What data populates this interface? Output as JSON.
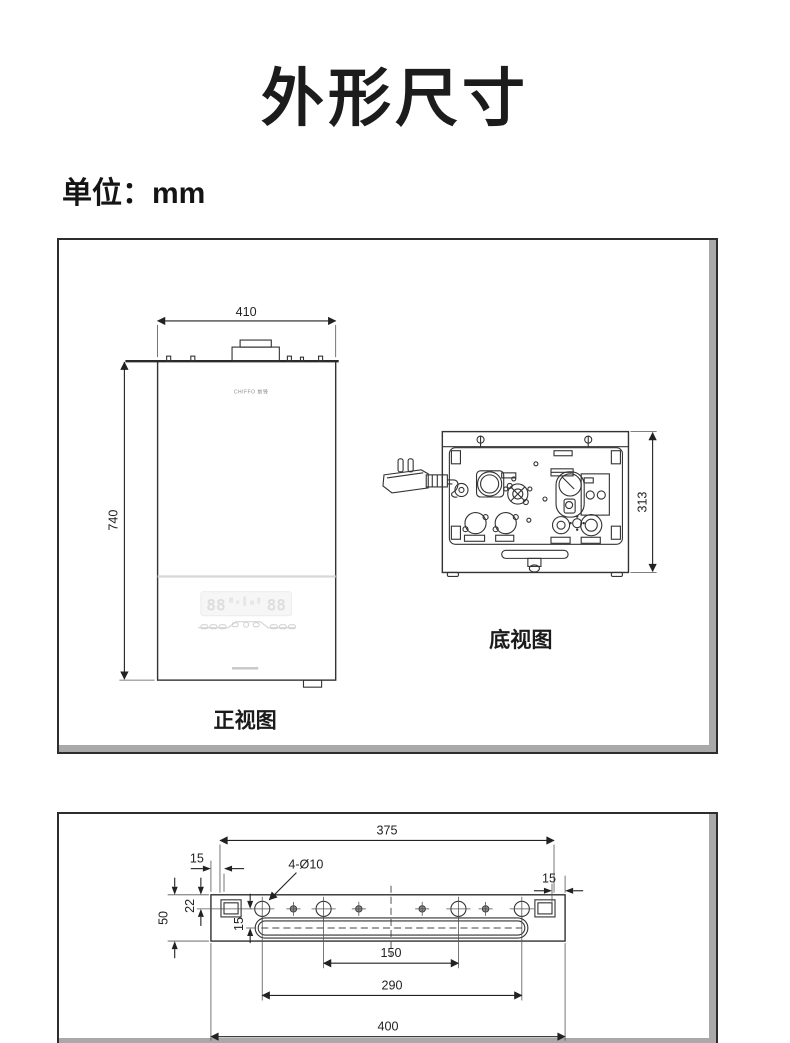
{
  "page": {
    "title": "外形尺寸",
    "unit_label": "单位：mm"
  },
  "views_panel": {
    "front_view": {
      "label": "正视图",
      "brand": "CHIFFO 前锋",
      "width_mm": "410",
      "height_mm": "740",
      "display_left": "88",
      "display_right": "88"
    },
    "bottom_view": {
      "label": "底视图",
      "depth_mm": "313"
    }
  },
  "bracket_panel": {
    "top_span_mm": "375",
    "left_offset_mm": "15",
    "right_offset_mm": "15",
    "holes_spec": "4-Ø10",
    "height_mm": "50",
    "hole_top_offset_mm": "22",
    "slot_offset_mm": "15",
    "inner_hole_span_mm": "150",
    "outer_hole_span_mm": "290",
    "overall_width_mm": "400"
  },
  "colors": {
    "line": "#333333",
    "box_border": "#2d2d2d",
    "box_shadow": "#a9a9a9",
    "display_gray": "#dedede"
  }
}
